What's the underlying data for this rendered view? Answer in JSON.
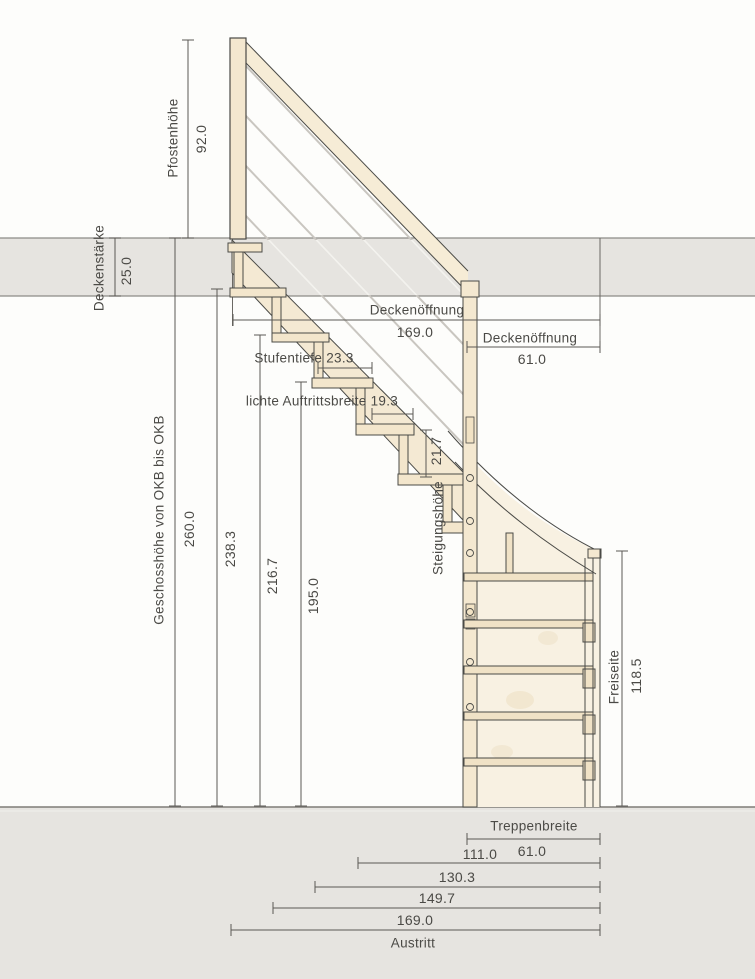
{
  "drawing_type": "staircase-section",
  "dimensions": {
    "pfostenhoehe": {
      "label": "Pfostenhöhe",
      "value": "92.0"
    },
    "deckenstaerke": {
      "label": "Deckenstärke",
      "value": "25.0"
    },
    "geschosshoehe": {
      "label": "Geschosshöhe von OKB bis OKB",
      "value": "260.0"
    },
    "zwischenhoehen": [
      "238.3",
      "216.7",
      "195.0"
    ],
    "deckenoeffnung_lang": {
      "label": "Deckenöffnung",
      "value": "169.0"
    },
    "deckenoeffnung_kurz": {
      "label": "Deckenöffnung",
      "value": "61.0"
    },
    "stufentiefe": {
      "text": "Stufentiefe 23.3"
    },
    "lichte_auftrittsbreite": {
      "text": "lichte Auftrittsbreite 19.3"
    },
    "steigungshoehe": {
      "label": "Steigungshöhe",
      "value": "21.7"
    },
    "freiseite": {
      "label": "Freiseite",
      "value": "118.5"
    },
    "treppenbreite": {
      "label": "Treppenbreite",
      "value": "61.0"
    },
    "austritt_breiten": [
      "111.0",
      "130.3",
      "149.7",
      "169.0"
    ],
    "austritt": "Austritt"
  },
  "colors": {
    "wood_light": "#f5ebd6",
    "wood_mid": "#f3e6cc",
    "panel": "#f8f1e2",
    "slab_gray": "#e6e4e0",
    "outline": "#4a4a46",
    "dimension": "#5b5954",
    "railing_rod": "#c9c6c0"
  }
}
